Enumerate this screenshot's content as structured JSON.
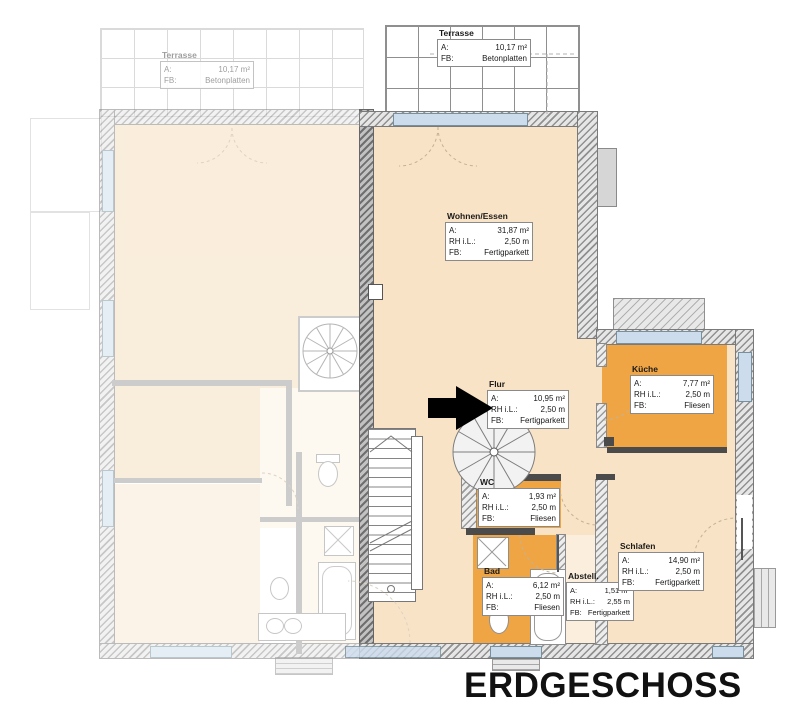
{
  "title": "ERDGESCHOSS",
  "field_labels": {
    "area": "A:",
    "height": "RH i.L.:",
    "floor": "FB:"
  },
  "rooms": {
    "terrasse_left": {
      "name": "Terrasse",
      "area": "10,17 m²",
      "floor": "Betonplatten"
    },
    "terrasse_right": {
      "name": "Terrasse",
      "area": "10,17 m²",
      "floor": "Betonplatten"
    },
    "wohnen_essen": {
      "name": "Wohnen/Essen",
      "area": "31,87 m²",
      "height": "2,50 m",
      "floor": "Fertigparkett"
    },
    "flur": {
      "name": "Flur",
      "area": "10,95 m²",
      "height": "2,50 m",
      "floor": "Fertigparkett"
    },
    "kueche": {
      "name": "Küche",
      "area": "7,77 m²",
      "height": "2,50 m",
      "floor": "Fliesen"
    },
    "wc": {
      "name": "WC",
      "area": "1,93 m²",
      "height": "2,50 m",
      "floor": "Fliesen"
    },
    "bad": {
      "name": "Bad",
      "area": "6,12 m²",
      "height": "2,50 m",
      "floor": "Fliesen"
    },
    "abstell": {
      "name": "Abstell.",
      "area": "1,51 m²",
      "height": "2,55 m",
      "floor": "Fertigparkett"
    },
    "schlafen": {
      "name": "Schlafen",
      "area": "14,90 m²",
      "height": "2,50 m",
      "floor": "Fertigparkett"
    }
  },
  "colors": {
    "room_fill": "#f8e3c6",
    "wet_room_fill": "#f0a544",
    "window_glass": "#cddcec",
    "wall_dark": "#4b4b4b",
    "arrow": "#000000",
    "title_text": "#111111"
  }
}
